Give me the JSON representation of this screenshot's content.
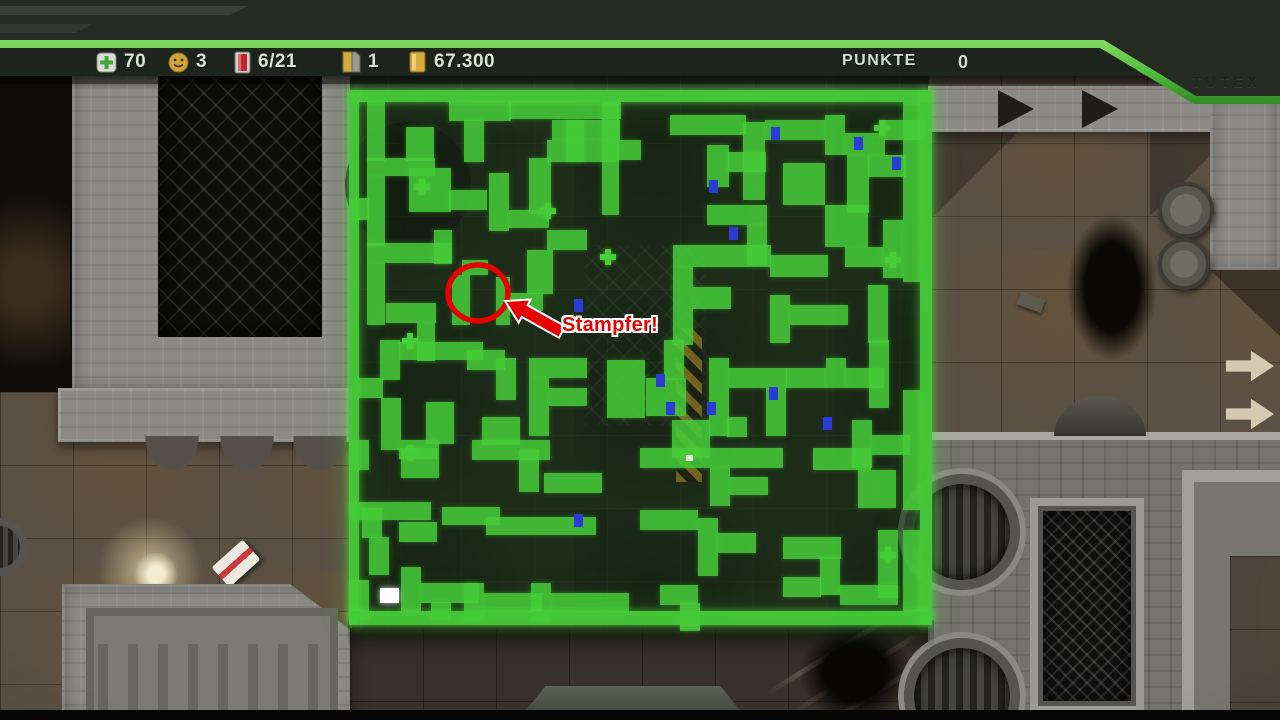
{
  "hud": {
    "items": [
      {
        "icon": "health-cross-icon",
        "value": "70"
      },
      {
        "icon": "smiley-lives-icon",
        "value": "3"
      },
      {
        "icon": "ammo-vial-icon",
        "value": "6/21"
      },
      {
        "icon": "keycard-icon",
        "value": "1"
      },
      {
        "icon": "gold-bar-icon",
        "value": "67.300"
      }
    ],
    "score_label": "PUNKTE",
    "score_value": "0",
    "panel_text": "TUTEX"
  },
  "annotation": {
    "label": "Stampfer!",
    "color": "#e60000"
  },
  "colors": {
    "map_green": "#46cd39",
    "door_blue": "#2a3bd8",
    "annotation_red": "#e60000",
    "hud_text": "#d7e8d2",
    "stripe_green": "#5abf3f"
  },
  "minimap": {
    "x": 349,
    "y": 90,
    "width": 583,
    "height": 535,
    "path_color": "#46cd39",
    "door_color": "#2a3bd8",
    "player_color": "#ffffff",
    "border": [
      [
        0,
        0,
        583,
        12
      ],
      [
        0,
        0,
        10,
        535
      ],
      [
        571,
        0,
        12,
        535
      ],
      [
        0,
        521,
        583,
        14
      ]
    ],
    "cells": [
      [
        18,
        11,
        18,
        60
      ],
      [
        100,
        11,
        62,
        20
      ],
      [
        115,
        30,
        20,
        42
      ],
      [
        160,
        11,
        112,
        18
      ],
      [
        203,
        30,
        68,
        20
      ],
      [
        57,
        37,
        28,
        34
      ],
      [
        18,
        68,
        68,
        18
      ],
      [
        18,
        86,
        18,
        70
      ],
      [
        60,
        78,
        42,
        44
      ],
      [
        100,
        100,
        38,
        20
      ],
      [
        0,
        108,
        20,
        22
      ],
      [
        140,
        83,
        20,
        58
      ],
      [
        160,
        120,
        40,
        18
      ],
      [
        180,
        68,
        22,
        56
      ],
      [
        198,
        50,
        72,
        22
      ],
      [
        217,
        30,
        18,
        42
      ],
      [
        253,
        13,
        17,
        112
      ],
      [
        270,
        50,
        22,
        20
      ],
      [
        18,
        153,
        84,
        20
      ],
      [
        85,
        140,
        18,
        34
      ],
      [
        18,
        173,
        18,
        62
      ],
      [
        37,
        213,
        50,
        20
      ],
      [
        68,
        233,
        18,
        38
      ],
      [
        103,
        185,
        18,
        50
      ],
      [
        113,
        170,
        26,
        15
      ],
      [
        147,
        187,
        14,
        48
      ],
      [
        50,
        252,
        84,
        18
      ],
      [
        160,
        203,
        34,
        18
      ],
      [
        178,
        160,
        26,
        44
      ],
      [
        198,
        140,
        40,
        20
      ],
      [
        31,
        250,
        20,
        40
      ],
      [
        10,
        288,
        24,
        20
      ],
      [
        32,
        308,
        20,
        52
      ],
      [
        50,
        358,
        38,
        11
      ],
      [
        77,
        312,
        28,
        42
      ],
      [
        118,
        260,
        38,
        20
      ],
      [
        147,
        268,
        20,
        42
      ],
      [
        133,
        327,
        38,
        28
      ],
      [
        180,
        268,
        58,
        20
      ],
      [
        180,
        288,
        20,
        58
      ],
      [
        200,
        298,
        38,
        18
      ],
      [
        258,
        270,
        38,
        58
      ],
      [
        297,
        288,
        40,
        38
      ],
      [
        315,
        250,
        20,
        40
      ],
      [
        360,
        268,
        20,
        78
      ],
      [
        380,
        278,
        58,
        20
      ],
      [
        417,
        298,
        20,
        48
      ],
      [
        378,
        327,
        20,
        20
      ],
      [
        437,
        278,
        40,
        20
      ],
      [
        477,
        268,
        20,
        30
      ],
      [
        497,
        278,
        38,
        20
      ],
      [
        520,
        250,
        20,
        68
      ],
      [
        321,
        25,
        76,
        20
      ],
      [
        394,
        32,
        22,
        78
      ],
      [
        416,
        30,
        60,
        20
      ],
      [
        476,
        25,
        20,
        40
      ],
      [
        496,
        43,
        40,
        22
      ],
      [
        536,
        30,
        40,
        20
      ],
      [
        358,
        55,
        22,
        42
      ],
      [
        379,
        62,
        38,
        20
      ],
      [
        434,
        73,
        42,
        42
      ],
      [
        498,
        65,
        22,
        58
      ],
      [
        519,
        65,
        38,
        22
      ],
      [
        476,
        115,
        43,
        42
      ],
      [
        358,
        115,
        60,
        20
      ],
      [
        398,
        135,
        20,
        40
      ],
      [
        324,
        155,
        98,
        22
      ],
      [
        421,
        165,
        58,
        22
      ],
      [
        534,
        130,
        20,
        58
      ],
      [
        554,
        12,
        17,
        180
      ],
      [
        496,
        157,
        38,
        20
      ],
      [
        324,
        177,
        20,
        78
      ],
      [
        344,
        197,
        38,
        22
      ],
      [
        421,
        205,
        20,
        48
      ],
      [
        441,
        215,
        58,
        20
      ],
      [
        519,
        195,
        20,
        58
      ],
      [
        323,
        330,
        38,
        38
      ],
      [
        291,
        358,
        143,
        20
      ],
      [
        361,
        378,
        20,
        38
      ],
      [
        381,
        387,
        38,
        18
      ],
      [
        464,
        358,
        58,
        22
      ],
      [
        503,
        330,
        20,
        48
      ],
      [
        523,
        345,
        38,
        20
      ],
      [
        509,
        380,
        38,
        38
      ],
      [
        291,
        420,
        58,
        20
      ],
      [
        349,
        428,
        20,
        58
      ],
      [
        369,
        443,
        38,
        20
      ],
      [
        434,
        447,
        58,
        22
      ],
      [
        471,
        467,
        20,
        38
      ],
      [
        434,
        487,
        38,
        20
      ],
      [
        529,
        440,
        20,
        68
      ],
      [
        491,
        495,
        58,
        20
      ],
      [
        311,
        495,
        38,
        20
      ],
      [
        331,
        513,
        20,
        28
      ],
      [
        52,
        350,
        38,
        38
      ],
      [
        0,
        350,
        20,
        30
      ],
      [
        123,
        350,
        78,
        20
      ],
      [
        170,
        360,
        20,
        42
      ],
      [
        195,
        383,
        58,
        20
      ],
      [
        0,
        412,
        82,
        18
      ],
      [
        93,
        417,
        58,
        18
      ],
      [
        137,
        427,
        110,
        18
      ],
      [
        13,
        418,
        20,
        30
      ],
      [
        50,
        432,
        38,
        20
      ],
      [
        20,
        447,
        20,
        38
      ],
      [
        0,
        490,
        20,
        40
      ],
      [
        52,
        477,
        20,
        44
      ],
      [
        72,
        493,
        58,
        20
      ],
      [
        82,
        512,
        20,
        18
      ],
      [
        115,
        493,
        20,
        38
      ],
      [
        135,
        503,
        58,
        20
      ],
      [
        182,
        493,
        20,
        38
      ],
      [
        202,
        503,
        78,
        20
      ],
      [
        554,
        300,
        17,
        120
      ],
      [
        554,
        440,
        17,
        81
      ]
    ],
    "plus_markers": [
      [
        73,
        97
      ],
      [
        199,
        121
      ],
      [
        259,
        167
      ],
      [
        61,
        251
      ],
      [
        533,
        38
      ],
      [
        544,
        170
      ],
      [
        61,
        363
      ],
      [
        539,
        465
      ]
    ],
    "doors": [
      [
        426,
        43
      ],
      [
        509,
        53
      ],
      [
        547,
        73
      ],
      [
        364,
        96
      ],
      [
        384,
        143
      ],
      [
        362,
        318
      ],
      [
        478,
        333
      ],
      [
        311,
        290
      ],
      [
        321,
        318
      ],
      [
        424,
        303
      ],
      [
        229,
        430
      ],
      [
        229,
        215
      ]
    ],
    "player": [
      31,
      498,
      19,
      15
    ],
    "dot": [
      337,
      365,
      7,
      6
    ]
  }
}
